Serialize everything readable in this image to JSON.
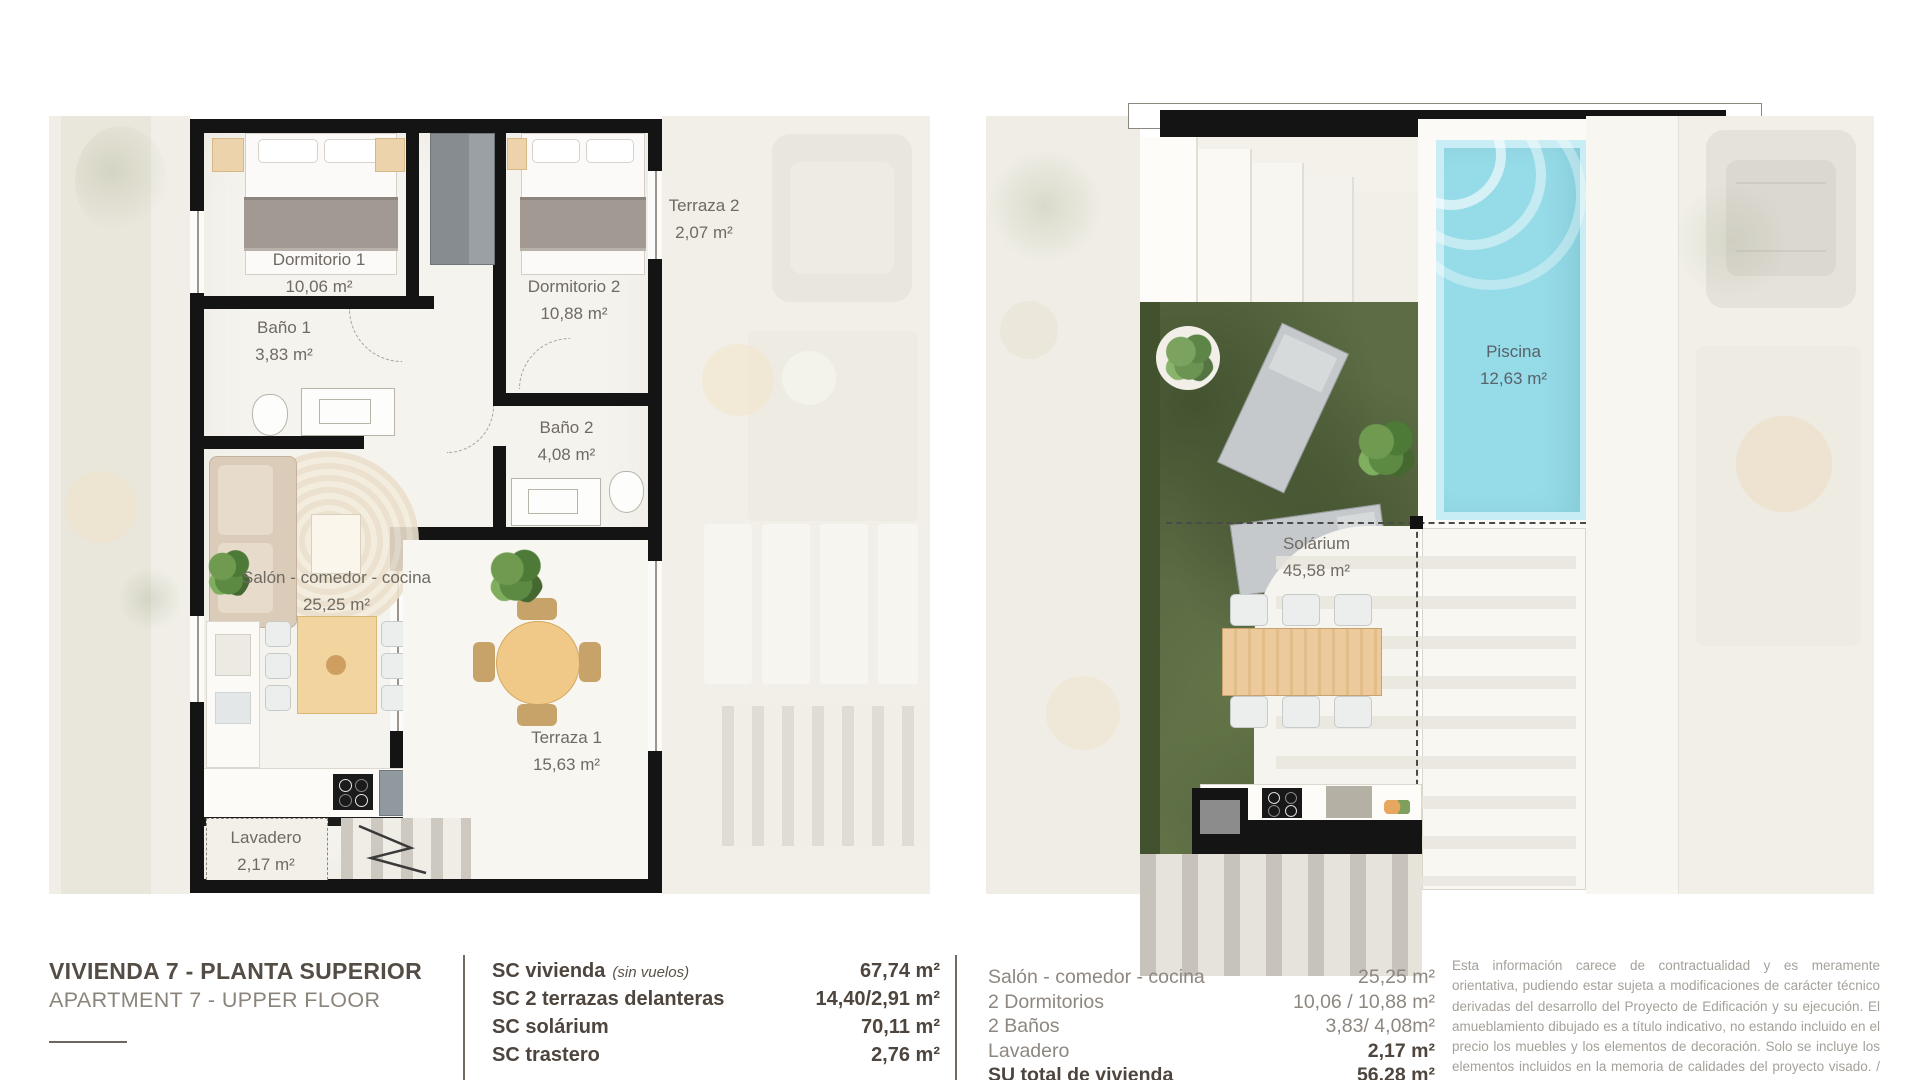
{
  "title": {
    "es": "VIVIENDA 7 - PLANTA SUPERIOR",
    "en": "APARTMENT 7 - UPPER FLOOR"
  },
  "plans": {
    "left": {
      "rooms": [
        {
          "name": "Dormitorio 1",
          "area": "10,06 m²"
        },
        {
          "name": "Dormitorio 2",
          "area": "10,88 m²"
        },
        {
          "name": "Terraza 2",
          "area": "2,07 m²"
        },
        {
          "name": "Baño 1",
          "area": "3,83 m²"
        },
        {
          "name": "Baño 2",
          "area": "4,08 m²"
        },
        {
          "name": "Salón - comedor - cocina",
          "area": "25,25 m²"
        },
        {
          "name": "Terraza 1",
          "area": "15,63 m²"
        },
        {
          "name": "Lavadero",
          "area": "2,17 m²"
        }
      ]
    },
    "right": {
      "rooms": [
        {
          "name": "Piscina",
          "area": "12,63 m²"
        },
        {
          "name": "Solárium",
          "area": "45,58 m²"
        }
      ]
    }
  },
  "summary": {
    "sc_rows": [
      {
        "label": "SC vivienda",
        "note": "(sin vuelos)",
        "value": "67,74 m²"
      },
      {
        "label": "SC 2 terrazas delanteras",
        "note": "",
        "value": "14,40/2,91 m²"
      },
      {
        "label": "SC solárium",
        "note": "",
        "value": "70,11 m²"
      },
      {
        "label": "SC trastero",
        "note": "",
        "value": "2,76 m²"
      }
    ],
    "room_rows": [
      {
        "label": "Salón - comedor - cocina",
        "value": "25,25 m²"
      },
      {
        "label": "2 Dormitorios",
        "value": "10,06 / 10,88 m²"
      },
      {
        "label": "2 Baños",
        "value": "3,83/ 4,08m²"
      },
      {
        "label": "Lavadero",
        "value": "2,17 m²"
      },
      {
        "label": "SU total de vivienda",
        "value": "56,28 m²"
      }
    ]
  },
  "disclaimer": "Esta información carece de contractualidad y es meramente orientativa, pudiendo estar sujeta a modificaciones de carácter técnico derivadas del desarrollo del Proyecto de Edificación y su ejecución. El amueblamiento dibujado es a título indicativo, no estando incluido en el precio los muebles y los elementos de decoración. Solo se incluye los elementos incluidos en la memoria de calidades del proyecto visado. / This information is not contractual and is merely",
  "watermark": ".com",
  "colors": {
    "wall": "#141414",
    "pool": "#96dbe8",
    "grass": "#5c6c44",
    "wood": "#f2d49e",
    "label_text": "#6f6a62",
    "title_text": "#544d45",
    "disclaimer_text": "#a5a099"
  }
}
